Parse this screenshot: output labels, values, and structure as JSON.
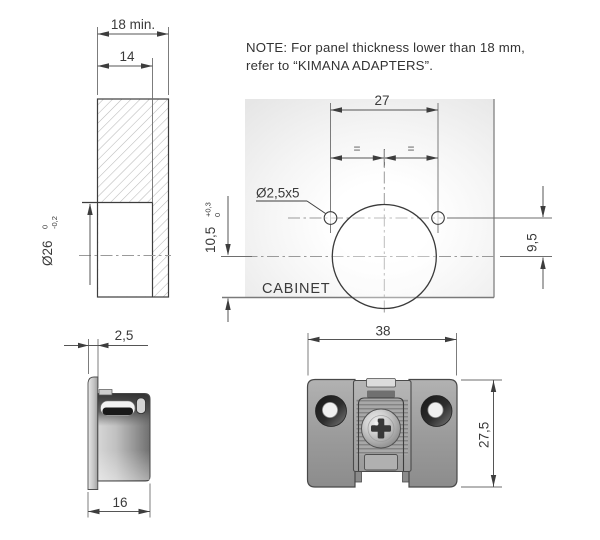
{
  "note": {
    "line1": "NOTE: For panel thickness lower than 18 mm,",
    "line2": "refer to “KIMANA ADAPTERS”."
  },
  "colors": {
    "line": "#3d3d3d",
    "cabinet_red": "#d22b45",
    "hatch": "#b9b9b9",
    "centerline": "#9a9a9a"
  },
  "section_view": {
    "thickness": "18 min.",
    "hole_depth": "14",
    "bore": "Ø26",
    "bore_tol_upper": "0",
    "bore_tol_lower": "-0,2"
  },
  "drilling_view": {
    "hole_spacing": "27",
    "equal_left": "=",
    "equal_right": "=",
    "screw_hole": "Ø2,5x5",
    "edge_distance": "10,5",
    "edge_tol_upper": "+0,3",
    "edge_tol_lower": "0",
    "axis_offset": "9,5",
    "cabinet_label": "CABINET"
  },
  "side_view": {
    "flange_thickness": "2,5",
    "body_depth": "16"
  },
  "front_view": {
    "width": "38",
    "height": "27,5"
  }
}
